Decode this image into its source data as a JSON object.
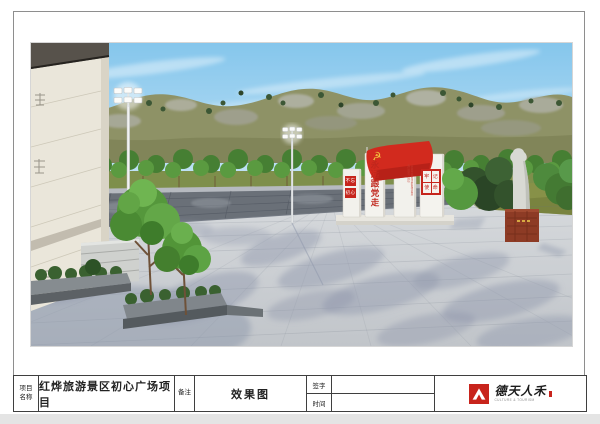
{
  "page": {
    "background": "#e4e4e4",
    "sheet_color": "#ffffff",
    "border_color": "#8e8e8e"
  },
  "title_block": {
    "project_label_lines": [
      "项目",
      "名称"
    ],
    "project_name": "红烨旅游景区初心广场项目",
    "remark_label": "备注",
    "remark_value": "效果图",
    "signature_label": "签字",
    "signature_value": "",
    "date_label": "时间",
    "date_value": ""
  },
  "logo": {
    "brand_text": "德天人禾",
    "caption": "CULTURE & TOURISM",
    "accent": "#c8241c"
  },
  "scene": {
    "monument": {
      "left_plaque_top": "不忘",
      "left_plaque_bottom": "初心",
      "calligraphy": "永远跟党走",
      "fine_print": "人民对美好生活的向往就是我们的奋斗目标",
      "right_plaque_chars": [
        "牢",
        "记",
        "使",
        "命"
      ],
      "flag_emblem": "☭",
      "red": "#c6251c",
      "flag_red": "#d22a1e",
      "emblem_gold": "#f2c23e"
    },
    "colors": {
      "sky_top": "#85c6ec",
      "sky_bottom": "#d8edf8",
      "mountain": "#8e9266",
      "treeline": "#4f8c3a",
      "wall": "#6a7078",
      "plaza": "#cdd1d5",
      "shadow": "#8e97ab",
      "grass": "#879148",
      "stele": "#f2f1ec",
      "statue": "#d8d9d3",
      "pedestal": "#8d3b25",
      "building": "#eae6da",
      "roof": "#57524b"
    }
  }
}
